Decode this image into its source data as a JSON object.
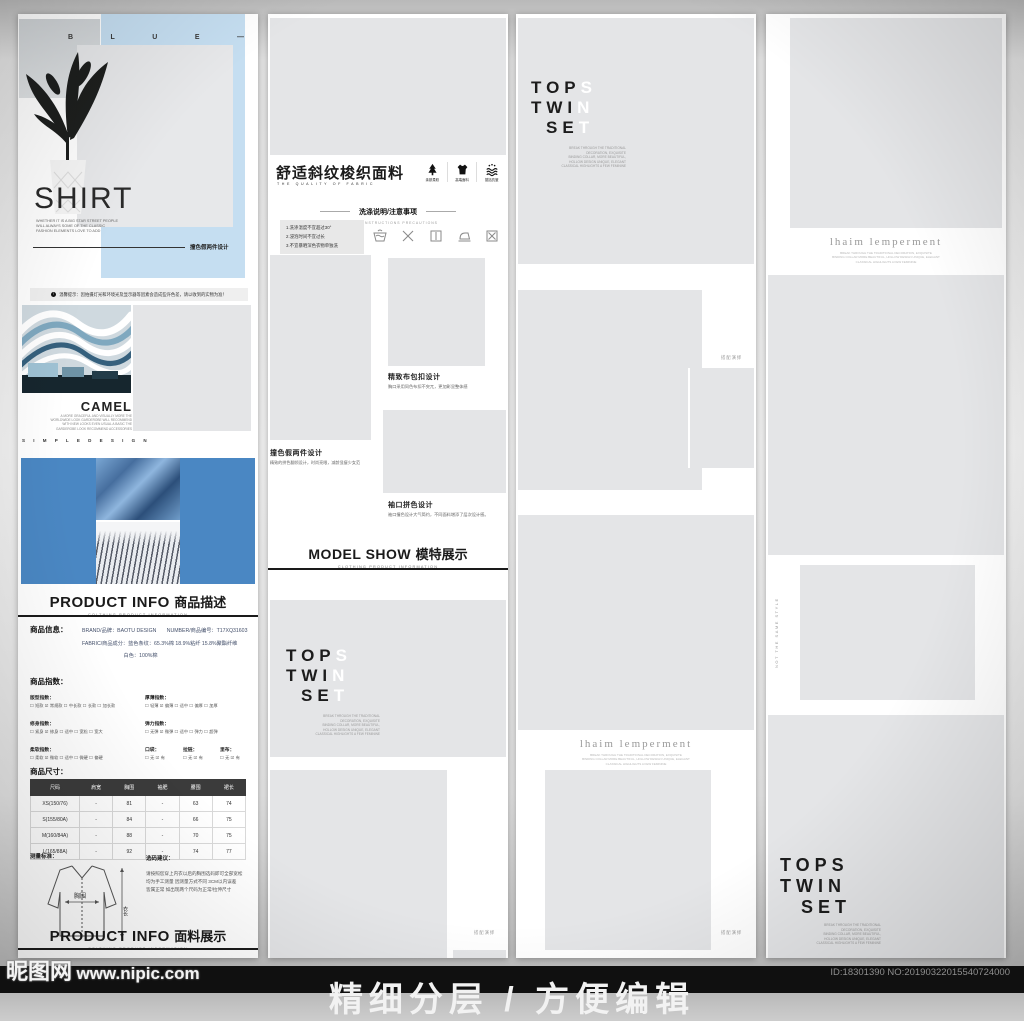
{
  "colors": {
    "accent_blue_light": "#c5def1",
    "accent_blue": "#4a87c3",
    "placeholder": "#e4e5e7"
  },
  "watermark": {
    "site": "昵图网",
    "url": "www.nipic.com",
    "idno": "ID:18301390 NO:20190322015540724000"
  },
  "footer": {
    "text": "精细分层 / 方便编辑"
  },
  "col1": {
    "blue_letters": [
      "B",
      "L",
      "U",
      "E",
      "—"
    ],
    "shirt_title": "SHIRT",
    "shirt_sub": "WHETHER IT IS A BIG STAR STREET PEOPLE\nWILL ALWAYS SOME OF THE CLASSIC\nFASHION ELEMENTS LOVE TO ADD",
    "tagline": "撞色假两件设计",
    "notice": "温馨提示：因拍摄灯光和环境光及显示器等因素会造成些许色差，请以收到的实物为准！",
    "camel_title": "CAMEL",
    "camel_sub": "A MORE GRACEFUL AND VISUALLY MORE THE\nWORLDWIDE LOOK GARDEROBE WILL RECOMMEND\nWITH NEW LOOKS EVEN USUAL A BASIC THE\nGARDEROBE LOOK RECOMMEND ACCESSORIES",
    "camel_footer": "S I M P L E   D E S I G N",
    "heading1_en": "PRODUCT INFO",
    "heading1_cn": "商品描述",
    "heading1_sub": "COLTHING PRODUCT INFORMATION",
    "info_label": "商品信息：",
    "info_lines": "BRAND/品牌：BAOTU DESIGN　　NUMBER/商品编号：T17XQ31603\nFABRIC/商品成分：蓝色条纹：65.3%棉 18.9%粘纤 15.8%聚酯纤维\n　　　　　　　　白色：100%棉",
    "index_label": "商品指数：",
    "index_groups": [
      {
        "title": "版型指数：",
        "opts": "☐ 短款  ☑ 常规款  ☐ 中长款  ☐ 长款  ☐ 加长款"
      },
      {
        "title": "厚薄指数：",
        "opts": "☐ 轻薄  ☑ 偏薄  ☐ 适中  ☐ 偏厚  ☐ 加厚"
      },
      {
        "title": "修身指数：",
        "opts": "☐ 紧身  ☑ 修身  ☐ 适中  ☐ 宽松  ☐ 宽大"
      },
      {
        "title": "弹力指数：",
        "opts": "☐ 无弹  ☑ 微弹  ☐ 适中  ☐ 弹力  ☐ 超弹"
      },
      {
        "title": "柔软指数：",
        "opts": "☐ 柔软  ☑ 微软  ☐ 适中  ☐ 微硬  ☐ 偏硬"
      },
      {
        "title": "口袋：",
        "opts": "☐ 无  ☑ 有"
      },
      {
        "title": "拉链：",
        "opts": "☐ 无  ☑ 有"
      },
      {
        "title": "里布：",
        "opts": "☐ 无  ☑ 有"
      }
    ],
    "size_label": "商品尺寸：",
    "size_headers": [
      "尺码",
      "肩宽",
      "胸围",
      "袖肥",
      "腰围",
      "裙长"
    ],
    "size_rows": [
      [
        "XS(150/76)",
        "-",
        "81",
        "-",
        "63",
        "74"
      ],
      [
        "S(155/80A)",
        "-",
        "84",
        "-",
        "66",
        "75"
      ],
      [
        "M(160/84A)",
        "-",
        "88",
        "-",
        "70",
        "75"
      ],
      [
        "L(165/88A)",
        "-",
        "92",
        "-",
        "74",
        "77"
      ]
    ],
    "measure_label": "测量标准：",
    "measure_chest": "胸围",
    "measure_length": "衣长",
    "suggest_label": "选码建议：",
    "suggest_text": "请按照您穿上内衣以后的胸围选码即可全部宽松\n均为手工测量 因测量方式不同 3CM以内误差\n皆属正常 如出现两个尺码为正常/拉伸尺寸",
    "heading2_en": "PRODUCT INFO",
    "heading2_cn": "面料展示",
    "heading2_sub": "COLTHING PRODUCT INFORMATION"
  },
  "col2": {
    "fabric_title": "舒适斜纹梭织面料",
    "fabric_sub": "THE QUALITY OF FABRIC",
    "features": [
      {
        "icon": "tree-icon",
        "label": "亲肤柔软"
      },
      {
        "icon": "tshirt-icon",
        "label": "高端面料"
      },
      {
        "icon": "wave-icon",
        "label": "挺括抗皱"
      }
    ],
    "wash_title": "洗涤说明/注意事项",
    "wash_sub": "WASHING INSTRUCTIONS PRECAUTIONS",
    "wash_notes": "1.洗涤温度不宜超过30°\n2.浸泡时间不宜过长\n3.不宜暴晒深色衣物单独洗",
    "wash_icons": [
      "handwash-icon",
      "no-bleach-icon",
      "drip-dry-icon",
      "iron-icon",
      "no-tumble-dry-icon"
    ],
    "detail1_title": "精致布包扣设计",
    "detail1_desc": "胸口采用同色布扣不突兀，更加彰显整体感",
    "detail2_title": "撞色假两件设计",
    "detail2_desc": "精致的拼色翻领设计，时尚亮眼，减龄显瘦少女范",
    "detail3_title": "袖口拼色设计",
    "detail3_desc": "袖口撞色设计大气简约，不同面料增添了层次设计感。",
    "model_en": "MODEL SHOW",
    "model_cn": "模特展示",
    "model_sub": "CLOTHING PRODUCT INFORMATION",
    "tops": {
      "r1d": "TOP",
      "r1l": "S",
      "r2d": "TWI",
      "r2l": "N",
      "r3d": "SE",
      "r3l": "T",
      "caption": "BREAK THROUGH THE TRADITIONAL\nDECORATION, EXQUISITE\nBINDING COLLAR, MORE BEAUTIFUL,\nHOLLOW DESIGN UNIQUE, ELEGANT\nCLASSICAL HIGHLIGHTS A FEW FEMININE"
    },
    "match_label": "搭配演绎"
  },
  "col3": {
    "tops": {
      "r1d": "TOP",
      "r1l": "S",
      "r2d": "TWI",
      "r2l": "N",
      "r3d": "SE",
      "r3l": "T",
      "caption": "BREAK THROUGH THE TRADITIONAL\nDECORATION, EXQUISITE\nBINDING COLLAR, MORE BEAUTIFUL,\nHOLLOW DESIGN UNIQUE, ELEGANT\nCLASSICAL HIGHLIGHTS A FEW FEMININE"
    },
    "match_label_1": "搭配演绎",
    "match_label_2": "搭配演绎",
    "lhaim_title": "lhaim lemperment",
    "lhaim_caption": "BREAK THROUGH THE TRADITIONAL DECORATION, EXQUISITE\nBINDING COLLAR MORE BEAUTIFUL, HOLLOW DESIGN UNIQUE, ELEGANT\nCLASSICAL HIGHLIGHTS A FEW FEMININE"
  },
  "col4": {
    "lhaim_title": "lhaim lemperment",
    "lhaim_caption": "BREAK THROUGH THE TRADITIONAL DECORATION, EXQUISITE\nBINDING COLLAR MORE BEAUTIFUL, HOLLOW DESIGN UNIQUE, ELEGANT\nCLASSICAL HIGHLIGHTS A FEW FEMININE",
    "vertical_text": "NOT THE SAME STYLE",
    "tops_dark": {
      "r1": "TOPS",
      "r2": "TWIN",
      "r3": "SET",
      "caption": "BREAK THROUGH THE TRADITIONAL\nDECORATION, EXQUISITE\nBINDING COLLAR, MORE BEAUTIFUL,\nHOLLOW DESIGN UNIQUE, ELEGANT\nCLASSICAL HIGHLIGHTS A FEW FEMININE"
    }
  }
}
